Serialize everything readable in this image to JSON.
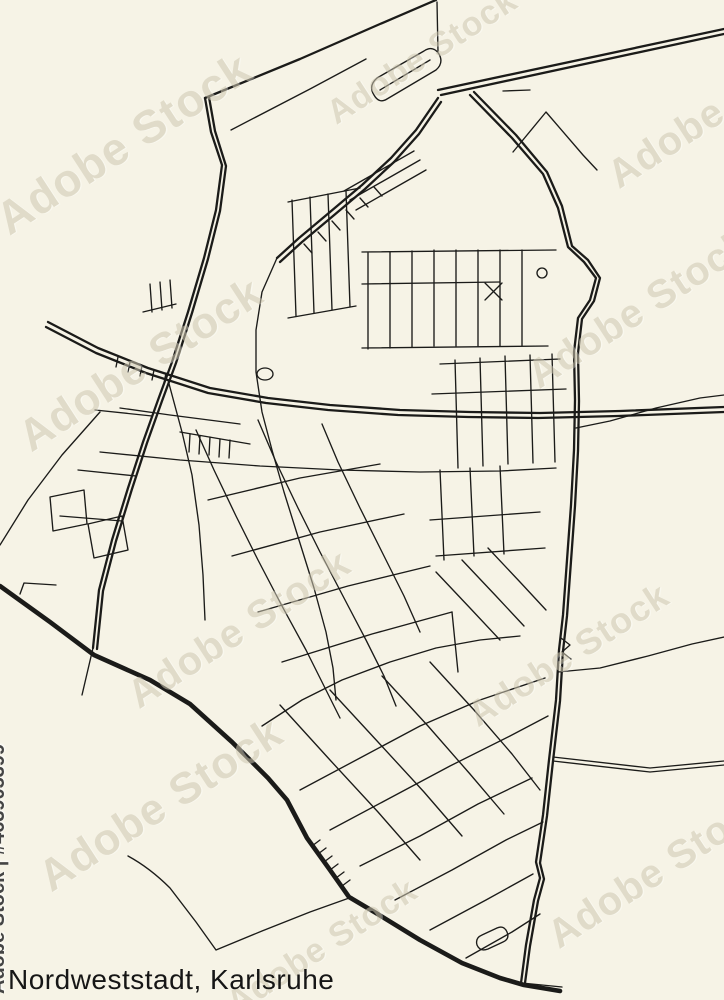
{
  "title": "Nordweststadt, Karlsruhe",
  "watermark": {
    "side_text": "Adobe Stock | #463905399",
    "diagonal_text": "Adobe Stock"
  },
  "colors": {
    "background": "#F6F3E6",
    "road": "#1B1B19",
    "title": "#161616",
    "watermark_diagonal": "#CFC9B2",
    "watermark_side": "#454545"
  },
  "roads": {
    "heavy": [
      "M0,586 L50,622 L94,655 L150,680 L190,704 L232,742 L268,778 L287,800 L307,838 L330,870 L349,897 L376,913 L420,940 L462,963 L500,978 L524,985 L560,991"
    ],
    "major": [
      "M438,90 L724,29",
      "M441,95 L724,34",
      "M205,98 L211,132 L222,165 L216,210 L204,258 L188,312 L172,362 L158,400 L143,442 L128,488 L112,540 L99,590 L93,648",
      "M209,97 L215,131 L226,166 L220,211 L208,259 L192,313 L176,363 L162,401 L147,443 L132,489 L116,541 L103,591 L97,649",
      "M48,322 L98,348 L148,368 L210,388 L268,398 L330,405 L400,410 L470,412 L540,413 L620,411 L724,407",
      "M46,327 L96,353 L146,373 L208,393 L266,403 L328,410 L398,415 L468,417 L538,418 L618,416 L724,412",
      "M470,95 L512,138 L543,174 L558,208 L568,247 L584,262 L596,278 L590,300 L578,318 L574,352 L575,400 L574,450 L571,505 L567,560 L563,615 L559,650 L556,700 L549,760 L543,815 L536,862 L540,878 L534,900 L526,945 L521,983",
      "M474,92 L516,135 L547,172 L562,206 L572,246 L588,260 L600,278 L594,301 L582,319 L578,353 L579,401 L578,451 L575,506 L571,561 L567,616 L563,651 L560,701 L553,761 L547,816 L540,863 L544,879 L538,901 L530,946 L525,983",
      "M438,98 L416,130 L391,158 L362,185 L330,212 L299,238 L277,258",
      "M441,102 L419,134 L394,162 L365,189 L333,216 L302,242 L280,262",
      "M205,98 L300,59 L380,24 L436,0"
    ],
    "minor": [
      "M231,130 L310,89 L366,59",
      "M437,2 L438,52",
      "M277,258 L262,292 L256,330 L256,372 L262,412 L272,450 L284,492 L299,540 L314,588 L326,632 L333,668 L336,700",
      "M374,95 Q368,86 377,78 L424,51 Q433,45 439,54 Q444,63 436,70 L387,99 Q379,104 374,95 Z",
      "M380,90 L430,60",
      "M350,200 L420,160",
      "M356,210 L426,170",
      "M344,191 L414,151",
      "M100,452 L180,460 L260,466 L340,470 L420,472 L500,471 L556,468",
      "M120,408 L170,415 L240,424",
      "M558,672 L600,668 L648,656 L692,644 L724,637",
      "M576,428 L610,421 L656,408 L700,398 L724,395",
      "M553,757 L650,768 L724,761",
      "M553,761 L650,772 L724,765",
      "M128,856 Q150,868 170,888 L196,922 L216,950 L262,931 L310,912 L352,897",
      "M522,983 L562,987",
      "M368,253 L368,349",
      "M390,252 L390,348",
      "M412,251 L412,347",
      "M434,250 L434,346",
      "M456,250 L456,346",
      "M478,250 L478,346",
      "M500,250 L500,346",
      "M522,250 L522,346",
      "M362,252 L556,250",
      "M362,284 L500,282",
      "M362,348 L548,346",
      "M292,200 L296,316",
      "M310,197 L314,313",
      "M328,194 L332,310",
      "M346,191 L350,307",
      "M288,202 L360,188",
      "M288,318 L356,306",
      "M304,244 L312,253",
      "M318,232 L326,241",
      "M332,221 L340,230",
      "M346,210 L354,219",
      "M360,198 L368,207",
      "M374,187 L382,196",
      "M440,364 L560,359",
      "M432,394 L566,389",
      "M455,360 L458,468",
      "M480,358 L483,466",
      "M505,356 L508,464",
      "M530,355 L533,463",
      "M552,354 L555,462",
      "M485,283 L502,300 M502,283 L485,300",
      "M537,273 a5,5 0 1 0 10,0 a5,5 0 1 0 -10,0",
      "M513,152 L546,112 L583,155 L597,170",
      "M503,91 L530,90",
      "M143,312 L176,304",
      "M150,284 L152,312",
      "M160,282 L162,310",
      "M170,280 L172,308",
      "M95,410 L152,416",
      "M100,412 L62,455 L28,500 L0,545",
      "M20,594 L24,583 L56,585",
      "M180,432 L250,444",
      "M190,434 L189,452",
      "M200,436 L199,454",
      "M210,437 L209,455",
      "M220,439 L219,457",
      "M230,440 L229,458",
      "M50,497 L84,490 L87,524 L53,531 Z",
      "M88,524 L122,516 L128,550 L94,558 Z",
      "M78,470 L136,476",
      "M60,516 L122,521",
      "M168,380 L182,432 L192,475 L199,525 L203,575 L205,620",
      "M93,648 L82,695",
      "M196,430 L214,470 L236,516 L258,560 L282,606 L306,650 L326,690 L340,718",
      "M258,420 L276,462 L298,508 L320,552 L344,598 L366,640 L384,676 L396,706",
      "M322,424 L338,462 L360,508 L382,552 L404,596 L420,632",
      "M208,500 L300,478 L380,464",
      "M232,556 L320,532 L404,514",
      "M258,612 L348,586 L430,566",
      "M282,662 L372,634 L452,612",
      "M452,612 L458,672",
      "M257,374 a8,6 0 1 0 16,0 a8,6 0 1 0 -16,0",
      "M440,470 L444,560",
      "M470,468 L474,556",
      "M500,466 L504,554",
      "M430,520 L540,512",
      "M436,556 L545,548",
      "M436,572 L470,608 L500,640",
      "M462,560 L496,596 L524,626",
      "M488,548 L520,582 L546,610",
      "M280,705 L330,760 L378,812 L420,860",
      "M330,690 L378,742 L424,792 L462,836",
      "M382,676 L428,726 L470,774 L504,814",
      "M430,662 L474,710 L512,754 L540,790",
      "M300,790 L360,758 L420,726 L480,700 L545,678",
      "M330,830 L390,798 L450,766 L510,736 L548,716",
      "M360,866 L420,836 L478,804 L532,778",
      "M395,900 L452,870 L506,840 L543,822",
      "M430,930 L486,900 L533,874",
      "M466,958 L512,932 L540,914",
      "M262,726 L302,700 L342,680 L390,662 L436,648 L480,640 L520,636",
      "M477,945 Q475,938 482,935 L497,928 Q504,925 507,932 Q510,939 503,942 L488,949 Q480,952 477,945 Z",
      "M312,846 L320,840",
      "M318,854 L326,848",
      "M324,862 L332,856",
      "M330,870 L338,864",
      "M336,878 L344,872",
      "M342,886 L350,880",
      "M118,357 L116,367",
      "M130,362 L128,372",
      "M142,366 L140,376",
      "M154,370 L152,380",
      "M166,373 L164,383",
      "M561,638 L570,645 L562,652 L571,659"
    ]
  }
}
